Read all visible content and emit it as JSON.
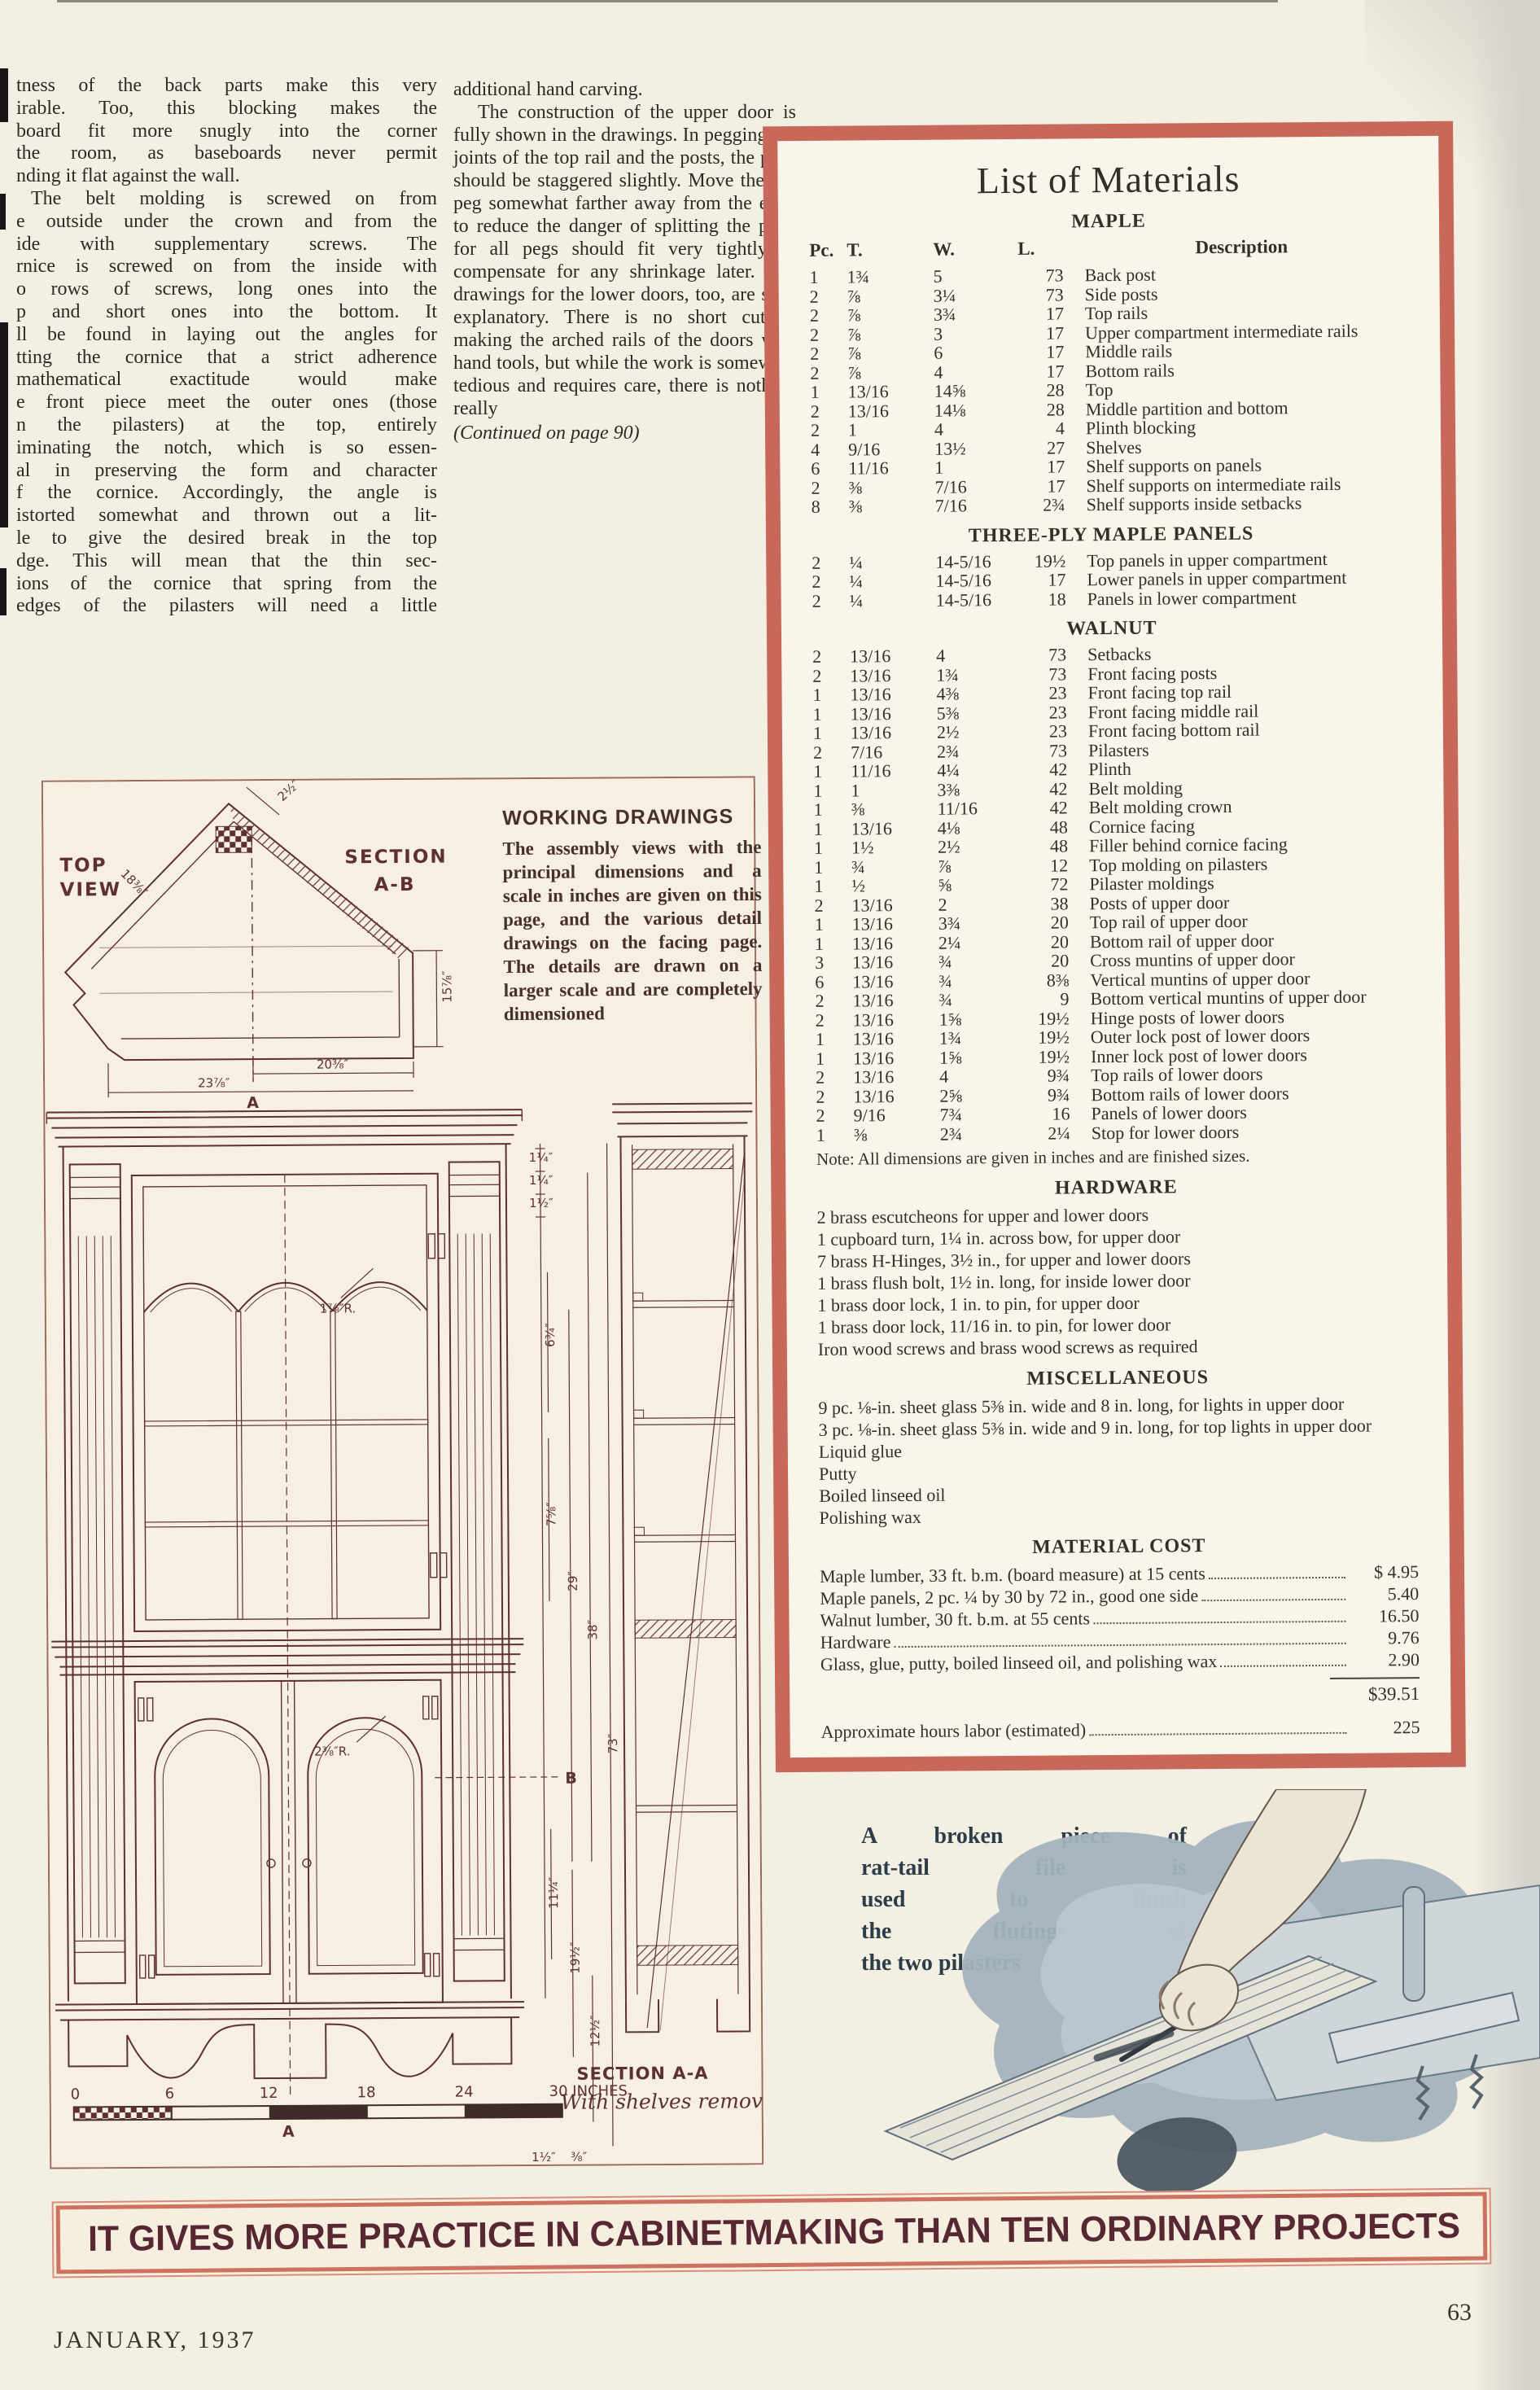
{
  "page": {
    "banner": "IT GIVES MORE PRACTICE IN CABINETMAKING THAN TEN ORDINARY PROJECTS",
    "footer_left": "JANUARY, 1937",
    "footer_right": "63"
  },
  "colors": {
    "box_border": "#c7685a",
    "banner_text": "#572733",
    "drawing_ink": "#5d3134",
    "page_bg": "#f3efe2"
  },
  "article": {
    "col1_lines": [
      "tness of the back parts make this very",
      "irable.  Too, this blocking makes the",
      "board fit more snugly into the corner",
      "the room, as baseboards never permit",
      "nding it flat against the wall.",
      "The belt molding is screwed on from",
      "e outside under the crown and from the",
      "ide with supplementary screws.  The",
      "rnice is screwed on from the inside with",
      "o rows of screws, long ones into the",
      "p and short ones into the bottom.  It",
      "ll be found in laying out the angles for",
      "tting the cornice that a strict adherence",
      "mathematical exactitude would make",
      "e front piece meet the outer ones (those",
      "n the pilasters) at the top, entirely",
      "iminating the notch, which is so essen-",
      "al in preserving the form and character",
      "f the cornice.  Accordingly, the angle is",
      "istorted somewhat and thrown out a lit-",
      "le to give the desired break in the top",
      "dge.  This will mean that the thin sec-",
      "ions of the cornice that spring from the",
      "edges of the pilasters will need a little"
    ],
    "col2_para1": "additional hand carving.",
    "col2_para2": "The construction of the upper door is fully shown in the drawings. In pegging the joints of the top rail and the posts, the pegs should be staggered slightly. Move the top peg somewhat farther away from the edge to reduce the danger of splitting the post, for all pegs should fit very tightly to compensate for any shrinkage later. The drawings for the lower doors, too, are self-explanatory. There is no short cut in making the arched rails of the doors with hand tools, but while the work is somewhat tedious and requires care, there is nothing really",
    "continued": "(Continued on page 90)"
  },
  "materials": {
    "title": "List of Materials",
    "headers": {
      "pc": "Pc.",
      "t": "T.",
      "w": "W.",
      "l": "L.",
      "desc": "Description"
    },
    "maple": {
      "heading": "MAPLE",
      "rows": [
        [
          "1",
          "1¾",
          "5",
          "73",
          "Back post"
        ],
        [
          "2",
          "⅞",
          "3¼",
          "73",
          "Side posts"
        ],
        [
          "2",
          "⅞",
          "3¾",
          "17",
          "Top rails"
        ],
        [
          "2",
          "⅞",
          "3",
          "17",
          "Upper compartment intermediate rails"
        ],
        [
          "2",
          "⅞",
          "6",
          "17",
          "Middle rails"
        ],
        [
          "2",
          "⅞",
          "4",
          "17",
          "Bottom rails"
        ],
        [
          "1",
          "13/16",
          "14⅝",
          "28",
          "Top"
        ],
        [
          "2",
          "13/16",
          "14⅛",
          "28",
          "Middle partition and bottom"
        ],
        [
          "2",
          "1",
          "4",
          "4",
          "Plinth blocking"
        ],
        [
          "4",
          "9/16",
          "13½",
          "27",
          "Shelves"
        ],
        [
          "6",
          "11/16",
          "1",
          "17",
          "Shelf supports on panels"
        ],
        [
          "2",
          "⅜",
          "7/16",
          "17",
          "Shelf supports on intermediate rails"
        ],
        [
          "8",
          "⅜",
          "7/16",
          "2¾",
          "Shelf supports inside setbacks"
        ]
      ]
    },
    "threeply": {
      "heading": "THREE-PLY MAPLE PANELS",
      "rows": [
        [
          "2",
          "¼",
          "14-5/16",
          "19½",
          "Top panels in upper compartment"
        ],
        [
          "2",
          "¼",
          "14-5/16",
          "17",
          "Lower panels in upper compartment"
        ],
        [
          "2",
          "¼",
          "14-5/16",
          "18",
          "Panels in lower compartment"
        ]
      ]
    },
    "walnut": {
      "heading": "WALNUT",
      "rows": [
        [
          "2",
          "13/16",
          "4",
          "73",
          "Setbacks"
        ],
        [
          "2",
          "13/16",
          "1¾",
          "73",
          "Front facing posts"
        ],
        [
          "1",
          "13/16",
          "4⅜",
          "23",
          "Front facing top rail"
        ],
        [
          "1",
          "13/16",
          "5⅜",
          "23",
          "Front facing middle rail"
        ],
        [
          "1",
          "13/16",
          "2½",
          "23",
          "Front facing bottom rail"
        ],
        [
          "2",
          "7/16",
          "2¾",
          "73",
          "Pilasters"
        ],
        [
          "1",
          "11/16",
          "4¼",
          "42",
          "Plinth"
        ],
        [
          "1",
          "1",
          "3⅜",
          "42",
          "Belt molding"
        ],
        [
          "1",
          "⅜",
          "11/16",
          "42",
          "Belt molding crown"
        ],
        [
          "1",
          "13/16",
          "4⅛",
          "48",
          "Cornice facing"
        ],
        [
          "1",
          "1½",
          "2½",
          "48",
          "Filler behind cornice facing"
        ],
        [
          "1",
          "¾",
          "⅞",
          "12",
          "Top molding on pilasters"
        ],
        [
          "1",
          "½",
          "⅝",
          "72",
          "Pilaster moldings"
        ],
        [
          "2",
          "13/16",
          "2",
          "38",
          "Posts of upper door"
        ],
        [
          "1",
          "13/16",
          "3¾",
          "20",
          "Top rail of upper door"
        ],
        [
          "1",
          "13/16",
          "2¼",
          "20",
          "Bottom rail of upper door"
        ],
        [
          "3",
          "13/16",
          "¾",
          "20",
          "Cross muntins of upper door"
        ],
        [
          "6",
          "13/16",
          "¾",
          "8⅜",
          "Vertical muntins of upper door"
        ],
        [
          "2",
          "13/16",
          "¾",
          "9",
          "Bottom vertical muntins of upper door"
        ],
        [
          "2",
          "13/16",
          "1⅝",
          "19½",
          "Hinge posts of lower doors"
        ],
        [
          "1",
          "13/16",
          "1¾",
          "19½",
          "Outer lock post of lower doors"
        ],
        [
          "1",
          "13/16",
          "1⅝",
          "19½",
          "Inner lock post of lower doors"
        ],
        [
          "2",
          "13/16",
          "4",
          "9¾",
          "Top rails of lower doors"
        ],
        [
          "2",
          "13/16",
          "2⅝",
          "9¾",
          "Bottom rails of lower doors"
        ],
        [
          "2",
          "9/16",
          "7¾",
          "16",
          "Panels of lower doors"
        ],
        [
          "1",
          "⅜",
          "2¾",
          "2¼",
          "Stop for lower doors"
        ]
      ]
    },
    "note": "Note: All dimensions are given in inches and are finished sizes.",
    "hardware": {
      "heading": "HARDWARE",
      "lines": [
        "2 brass escutcheons for upper and lower doors",
        "1 cupboard turn, 1¼ in. across bow, for upper door",
        "7 brass H-Hinges, 3½ in., for upper and lower doors",
        "1 brass flush bolt, 1½ in. long, for inside lower door",
        "1 brass door lock, 1 in. to pin, for upper door",
        "1 brass door lock, 11/16 in. to pin, for lower door",
        "Iron wood screws and brass wood screws as required"
      ]
    },
    "misc": {
      "heading": "MISCELLANEOUS",
      "lines": [
        "9 pc. ⅛-in. sheet glass 5⅜ in. wide and 8 in. long, for lights in upper door",
        "3 pc. ⅛-in. sheet glass 5⅜ in. wide and 9 in. long, for top lights in upper door",
        "Liquid glue",
        "Putty",
        "Boiled linseed oil",
        "Polishing wax"
      ]
    },
    "cost": {
      "heading": "MATERIAL COST",
      "rows": [
        {
          "label": "Maple lumber, 33 ft. b.m. (board measure) at 15 cents",
          "amount": "$ 4.95"
        },
        {
          "label": "Maple panels, 2 pc. ¼ by 30 by 72 in., good one side",
          "amount": "5.40"
        },
        {
          "label": "Walnut lumber, 30 ft. b.m. at 55 cents",
          "amount": "16.50"
        },
        {
          "label": "Hardware",
          "amount": "9.76"
        },
        {
          "label": "Glass, glue, putty, boiled linseed oil, and polishing wax",
          "amount": "2.90"
        }
      ],
      "total": "$39.51",
      "labor_label": "Approximate hours labor (estimated)",
      "labor_value": "225"
    }
  },
  "drawings": {
    "working_title": "WORKING DRAWINGS",
    "working_body": "The assembly views with the principal dimensions and a scale in inches are given on this page, and the various detail drawings on the facing page. The details are drawn on a larger scale and are completely dimensioned",
    "top_view_line1": "TOP",
    "top_view_line2": "VIEW",
    "section_ab_line1": "SECTION",
    "section_ab_line2": "A-B",
    "section_aa": "SECTION A-A",
    "section_aa_sub": "With shelves removed",
    "scale": [
      "0",
      "6",
      "12",
      "18",
      "24",
      "30 INCHES"
    ],
    "dims": {
      "tv_2_5": "2½″",
      "tv_18": "18⅜″",
      "tv_15": "15⅞″",
      "tv_20": "20⅜″",
      "tv_23": "23⅞″",
      "marker_a_top": "A",
      "marker_a_bottom": "A",
      "marker_b": "B",
      "arch_r_upper": "1⅞″R.",
      "arch_r_lower": "2⅜″R.",
      "c_1a": "1¼″",
      "c_1b": "1¼″",
      "c_1c": "1½″",
      "c_63": "6¾″",
      "c_75": "7⅝″",
      "c_29": "29″",
      "c_38": "38″",
      "c_73": "73″",
      "c_11": "11¼″",
      "c_19": "19½″",
      "c_12": "12½″",
      "c_1d": "1½″",
      "c_38s": "⅜″"
    }
  },
  "file_caption": {
    "lines": [
      "A broken piece of",
      "rat-tail file is",
      "used to finish",
      "the flutings of",
      "the two pilasters"
    ]
  }
}
